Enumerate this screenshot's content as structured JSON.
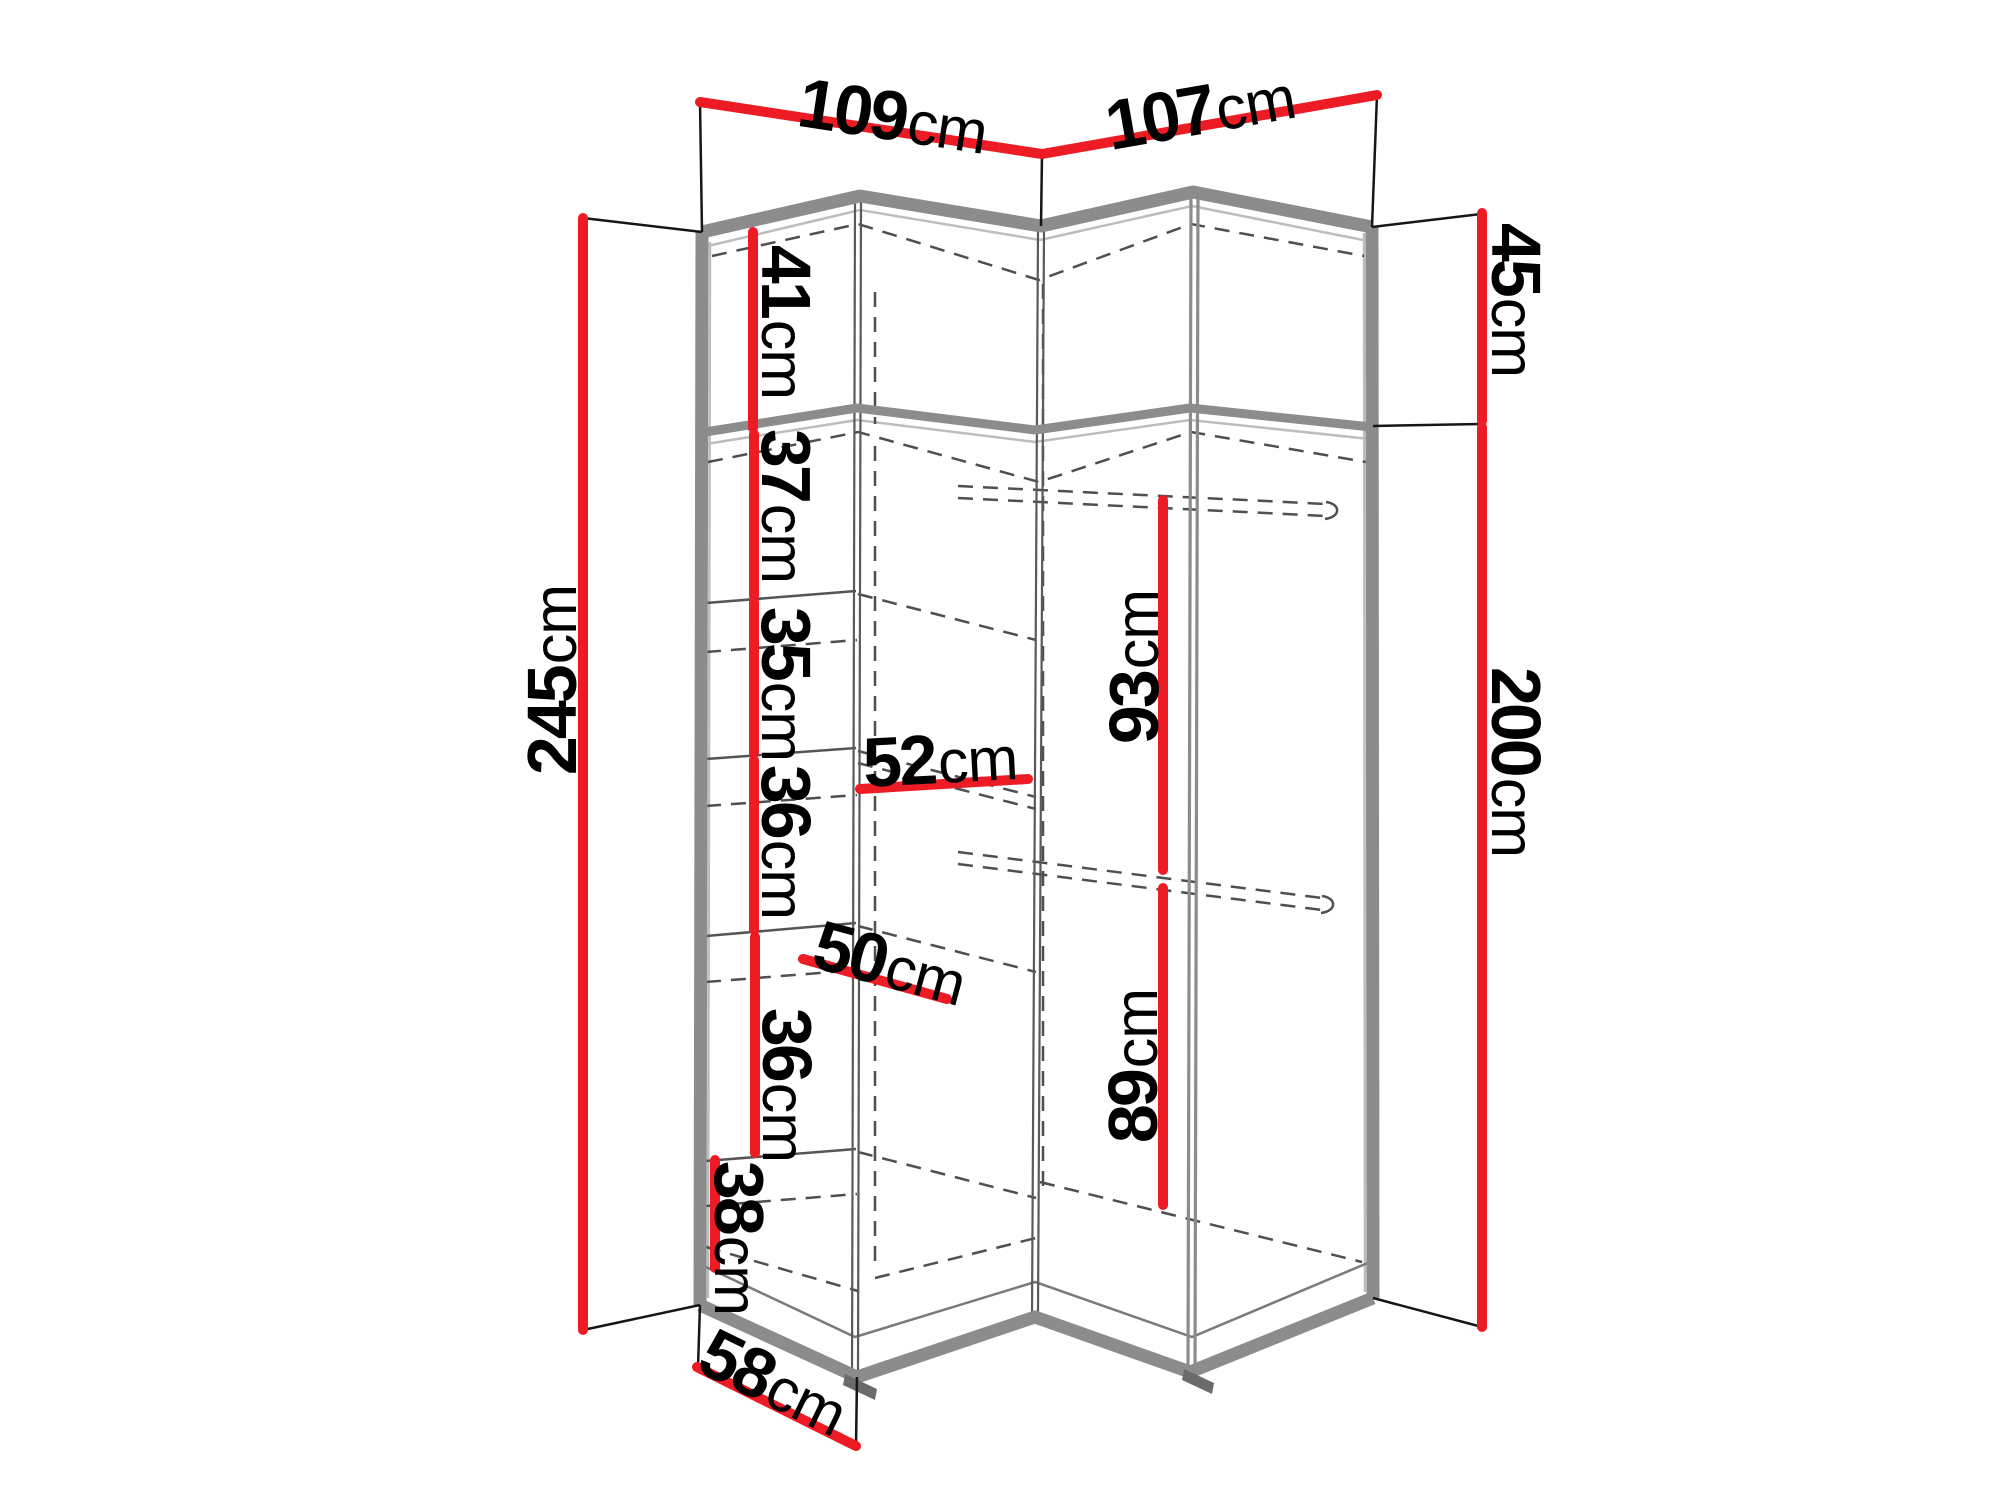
{
  "diagram": {
    "type": "corner-wardrobe-dimension-drawing",
    "unit": "cm",
    "colors": {
      "dimension_line": "#ed1b24",
      "frame_gray": "#8c8c8c",
      "text": "#000000"
    },
    "dims": {
      "top_width_left": {
        "num": "109",
        "unit": "cm"
      },
      "top_width_right": {
        "num": "107",
        "unit": "cm"
      },
      "upper_cabinet_height": {
        "num": "45",
        "unit": "cm"
      },
      "total_height": {
        "num": "245",
        "unit": "cm"
      },
      "lower_height": {
        "num": "200",
        "unit": "cm"
      },
      "shelf_gap_1": {
        "num": "41",
        "unit": "cm"
      },
      "shelf_gap_2": {
        "num": "37",
        "unit": "cm"
      },
      "shelf_gap_3": {
        "num": "35",
        "unit": "cm"
      },
      "shelf_gap_4": {
        "num": "36",
        "unit": "cm"
      },
      "shelf_gap_5": {
        "num": "36",
        "unit": "cm"
      },
      "shelf_gap_6": {
        "num": "38",
        "unit": "cm"
      },
      "shelf_width": {
        "num": "52",
        "unit": "cm"
      },
      "shelf_depth": {
        "num": "50",
        "unit": "cm"
      },
      "hanging_height_top": {
        "num": "93",
        "unit": "cm"
      },
      "hanging_height_bottom": {
        "num": "89",
        "unit": "cm"
      },
      "side_depth": {
        "num": "58",
        "unit": "cm"
      }
    }
  }
}
